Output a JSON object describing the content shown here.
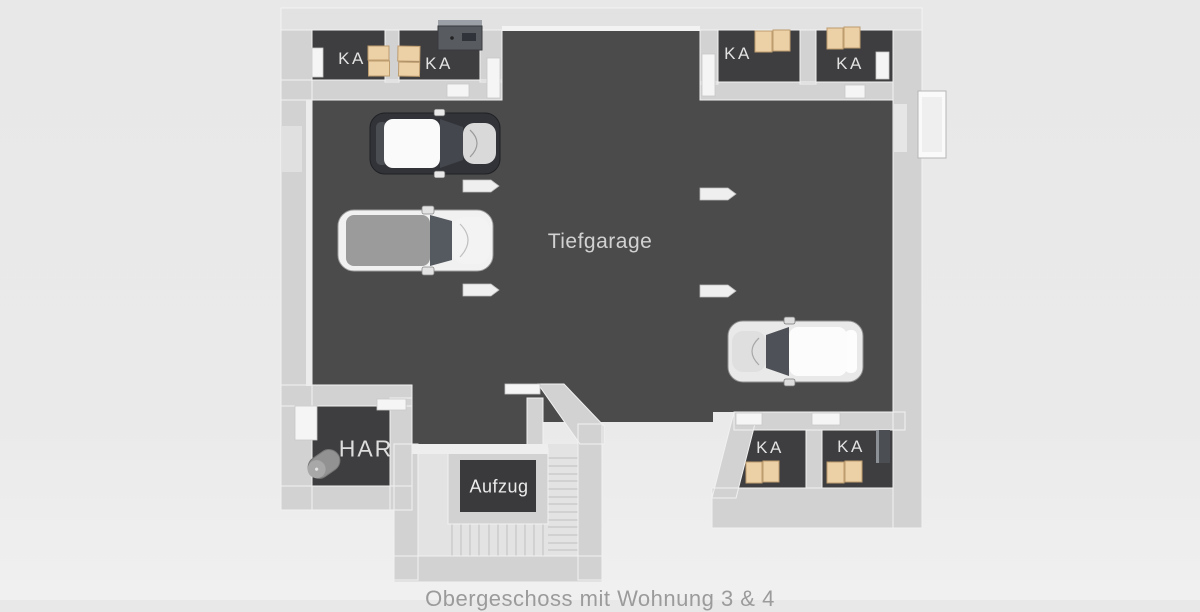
{
  "caption": {
    "text": "Obergeschoss mit Wohnung 3 & 4"
  },
  "plan": {
    "garage": {
      "label": "Tiefgarage"
    },
    "elevator": {
      "label": "Aufzug"
    },
    "utility_room": {
      "label": "HAR"
    },
    "storage_rooms": [
      {
        "label": "KA"
      },
      {
        "label": "KA"
      },
      {
        "label": "KA"
      },
      {
        "label": "KA"
      },
      {
        "label": "KA"
      },
      {
        "label": "KA"
      }
    ],
    "cars": [
      {
        "description": "dark car with white roof",
        "facing": "right"
      },
      {
        "description": "white SUV with gray roof",
        "facing": "right"
      },
      {
        "description": "white car with dark windshield",
        "facing": "left"
      }
    ],
    "colors": {
      "background": "#e9e9e9",
      "garage_floor": "#4b4b4c",
      "room_floor": "#3e3e40",
      "wall": "#d2d2d2",
      "wall_top": "#f2f2f2",
      "stairs": "#e3e3e3",
      "storage_box": "#ecd0a6",
      "label_text": "#d9d9d9",
      "caption_text": "#9b9b9b"
    }
  }
}
